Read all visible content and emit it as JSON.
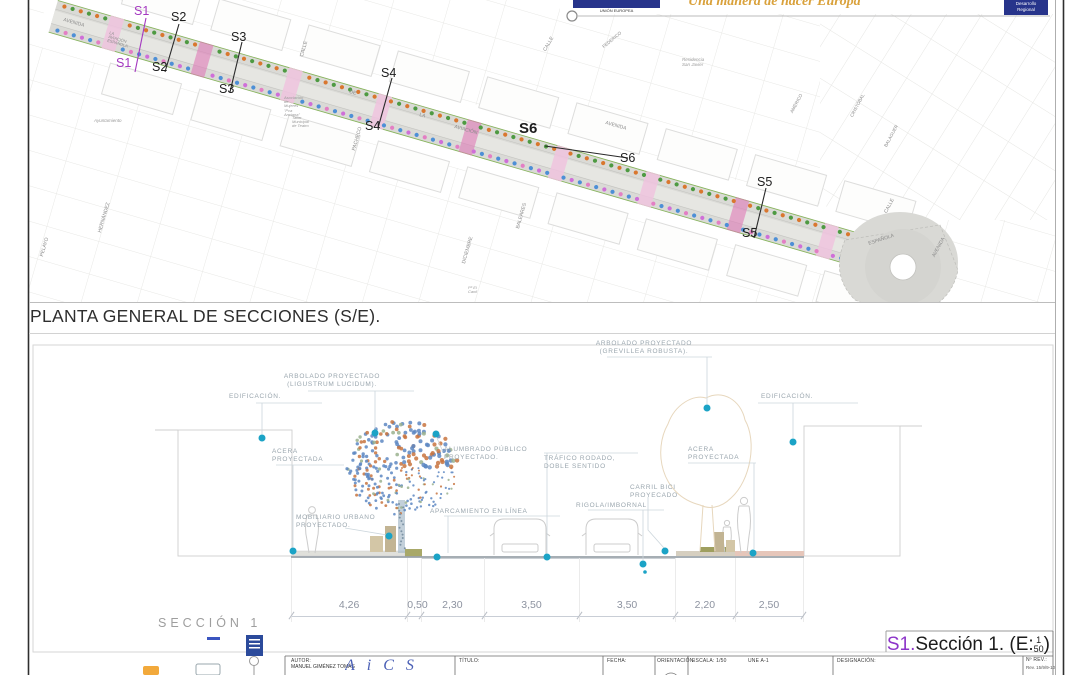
{
  "header": {
    "eu_caption": "UNIÓN EUROPEA",
    "slogan": "Una manera de hacer Europa",
    "feder_line1": "Desarrollo",
    "feder_line2": "Regional"
  },
  "plan": {
    "title": "PLANTA GENERAL DE SECCIONES (S/E).",
    "markers": [
      {
        "t": "S1",
        "x": 134,
        "y": 5,
        "purple": true,
        "bold": false
      },
      {
        "t": "S1",
        "x": 116,
        "y": 57,
        "purple": true,
        "bold": false
      },
      {
        "t": "S2",
        "x": 171,
        "y": 11,
        "purple": false,
        "bold": false
      },
      {
        "t": "S2",
        "x": 152,
        "y": 61,
        "purple": false,
        "bold": false
      },
      {
        "t": "S3",
        "x": 231,
        "y": 31,
        "purple": false,
        "bold": false
      },
      {
        "t": "S3",
        "x": 219,
        "y": 83,
        "purple": false,
        "bold": false
      },
      {
        "t": "S4",
        "x": 381,
        "y": 67,
        "purple": false,
        "bold": false
      },
      {
        "t": "S4",
        "x": 365,
        "y": 120,
        "purple": false,
        "bold": false
      },
      {
        "t": "S6",
        "x": 519,
        "y": 121,
        "purple": false,
        "bold": true
      },
      {
        "t": "S6",
        "x": 620,
        "y": 152,
        "purple": false,
        "bold": false
      },
      {
        "t": "S5",
        "x": 757,
        "y": 176,
        "purple": false,
        "bold": false
      },
      {
        "t": "S5",
        "x": 742,
        "y": 227,
        "purple": false,
        "bold": false
      }
    ],
    "streets": [
      {
        "t": "AVENIDA",
        "x": 64,
        "y": 18,
        "r": 16,
        "s": 5,
        "i": 0
      },
      {
        "t": "LA  AVIACIÓN  ESPAÑOLA",
        "x": 110,
        "y": 31,
        "r": 16,
        "s": 4,
        "i": 0
      },
      {
        "t": "DE",
        "x": 350,
        "y": 90,
        "r": 16,
        "s": 5,
        "i": 0
      },
      {
        "t": "LA",
        "x": 420,
        "y": 113,
        "r": 16,
        "s": 5,
        "i": 0
      },
      {
        "t": "AVIACIÓN",
        "x": 455,
        "y": 125,
        "r": 16,
        "s": 5,
        "i": 0
      },
      {
        "t": "AVENIDA",
        "x": 606,
        "y": 121,
        "r": 16,
        "s": 5,
        "i": 0
      },
      {
        "t": "CALLE",
        "x": 300,
        "y": 56,
        "r": -74,
        "s": 5,
        "i": 0
      },
      {
        "t": "PACHECO",
        "x": 352,
        "y": 150,
        "r": -74,
        "s": 5,
        "i": 0
      },
      {
        "t": "CALLE",
        "x": 543,
        "y": 50,
        "r": -60,
        "s": 5,
        "i": 0
      },
      {
        "t": "FEDERICO",
        "x": 602,
        "y": 46,
        "r": -40,
        "s": 4.5,
        "i": 0
      },
      {
        "t": "Residencia San Javier",
        "x": 682,
        "y": 58,
        "r": 0,
        "s": 4.5,
        "i": 1
      },
      {
        "t": "AMÉRICO",
        "x": 790,
        "y": 112,
        "r": -62,
        "s": 4.5,
        "i": 0
      },
      {
        "t": "CRISTÓBAL",
        "x": 850,
        "y": 116,
        "r": -62,
        "s": 4.5,
        "i": 0
      },
      {
        "t": "BALAGUER",
        "x": 884,
        "y": 146,
        "r": -62,
        "s": 4.5,
        "i": 0
      },
      {
        "t": "ESPAÑOLA",
        "x": 868,
        "y": 242,
        "r": -18,
        "s": 5,
        "i": 0
      },
      {
        "t": "CALLE",
        "x": 884,
        "y": 212,
        "r": -62,
        "s": 5,
        "i": 0
      },
      {
        "t": "AVENIDA",
        "x": 932,
        "y": 256,
        "r": -62,
        "s": 5,
        "i": 0
      },
      {
        "t": "Ayuntamiento",
        "x": 94,
        "y": 119,
        "r": 0,
        "s": 4.5,
        "i": 1
      },
      {
        "t": "Asociación de Mujeres\n\"Pca Anciana\"",
        "x": 284,
        "y": 96,
        "r": 0,
        "s": 4,
        "i": 1
      },
      {
        "t": "Taller Municipal\nde Teatro",
        "x": 292,
        "y": 116,
        "r": 0,
        "s": 4,
        "i": 1
      },
      {
        "t": "PELAYO",
        "x": 40,
        "y": 256,
        "r": -74,
        "s": 5,
        "i": 0
      },
      {
        "t": "HERNÁNDEZ",
        "x": 98,
        "y": 232,
        "r": -74,
        "s": 5,
        "i": 0
      },
      {
        "t": "BALEARES",
        "x": 516,
        "y": 228,
        "r": -74,
        "s": 5,
        "i": 0
      },
      {
        "t": "DICIEMBRE",
        "x": 462,
        "y": 263,
        "r": -74,
        "s": 5,
        "i": 0
      },
      {
        "t": "Pº  El Canil",
        "x": 468,
        "y": 286,
        "r": 0,
        "s": 4,
        "i": 1
      }
    ]
  },
  "section": {
    "name": "SECCIÓN 1",
    "caption": {
      "s": "S1.",
      "text": "Sección 1. (E:",
      "num": "1",
      "den": "50",
      "close": ")"
    },
    "callouts": [
      {
        "t": "EDIFICACIÓN.",
        "x": 229,
        "y": 393,
        "w": 70,
        "a": "left"
      },
      {
        "t": "ARBOLADO  PROYECTADO\n(LIGUSTRUM  LUCIDUM).",
        "x": 268,
        "y": 373,
        "w": 128,
        "a": "center"
      },
      {
        "t": "ARBOLADO  PROYECTADO\n(GREVILLEA  ROBUSTA).",
        "x": 580,
        "y": 340,
        "w": 128,
        "a": "center"
      },
      {
        "t": "EDIFICACIÓN.",
        "x": 761,
        "y": 393,
        "w": 70,
        "a": "left"
      },
      {
        "t": "ACERA\nPROYECTADA",
        "x": 272,
        "y": 448,
        "w": 60,
        "a": "left"
      },
      {
        "t": "ALUMBRADO  PÚBLICO\nPROYECTADO.",
        "x": 444,
        "y": 446,
        "w": 112,
        "a": "left"
      },
      {
        "t": "TRÁFICO  RODADO,\nDOBLE  SENTIDO",
        "x": 544,
        "y": 455,
        "w": 100,
        "a": "left"
      },
      {
        "t": "ACERA\nPROYECTADA",
        "x": 688,
        "y": 446,
        "w": 60,
        "a": "left"
      },
      {
        "t": "CARRIL  BICI\nPROYECADO",
        "x": 630,
        "y": 484,
        "w": 64,
        "a": "left"
      },
      {
        "t": "RIGOLA/IMBORNAL",
        "x": 576,
        "y": 502,
        "w": 96,
        "a": "left"
      },
      {
        "t": "APARCAMIENTO  EN  LÍNEA",
        "x": 430,
        "y": 508,
        "w": 134,
        "a": "left"
      },
      {
        "t": "MOBILIARIO  URBANO\nPROYECTADO.",
        "x": 296,
        "y": 514,
        "w": 106,
        "a": "left"
      }
    ],
    "dimensions": {
      "display": [
        "4,26",
        "0,50",
        "2,30",
        "3,50",
        "3,50",
        "2,20",
        "2,50"
      ],
      "meters": [
        4.26,
        0.5,
        2.3,
        3.5,
        3.5,
        2.2,
        2.5
      ]
    }
  },
  "titleblock": {
    "autor_label": "AUTOR:",
    "autor_name": "MANUEL GIMÉNEZ TOMÁS",
    "logo_letters": "AiCS",
    "titulo_label": "TÍTULO:",
    "fecha_label": "FECHA:",
    "orientacion_label": "ORIENTACIÓN:",
    "escala": "ESCALA: 1/50",
    "formato": "UNE A-1",
    "designacion_label": "DESIGNACIÓN:",
    "nrev_label": "Nº REV.:",
    "rev": "Rev. 15/9/9-10"
  },
  "colors": {
    "accent_teal": "#1ba3c6",
    "marker_purple": "#a438c0",
    "slogan_orange": "#d9a13b",
    "eu_blue": "#27348b",
    "dot_orange": "#d9772f",
    "dot_green": "#4e9a42",
    "dot_blue": "#4d8fd6",
    "dot_pink": "#e37fc4"
  }
}
